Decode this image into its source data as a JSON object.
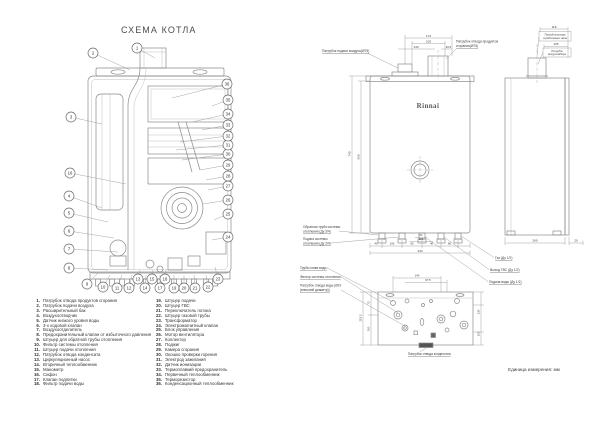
{
  "page": {
    "title": "СХЕМА КОТЛА",
    "unit_note": "Единица измерения: мм",
    "brand": "Rinnai"
  },
  "parts_list": [
    {
      "num": "1.",
      "label": "Патрубок отвода продуктов сгорания"
    },
    {
      "num": "2.",
      "label": "Патрубок подачи воздуха"
    },
    {
      "num": "3.",
      "label": "Расширительный бак"
    },
    {
      "num": "4.",
      "label": "Воздухоотводчик"
    },
    {
      "num": "5.",
      "label": "Датчик низкого уровня воды"
    },
    {
      "num": "6.",
      "label": "3-х ходовой клапан"
    },
    {
      "num": "7.",
      "label": "Воздухоотделитель"
    },
    {
      "num": "8.",
      "label": "Предохранительный клапан от избыточного давления"
    },
    {
      "num": "9.",
      "label": "Штуцер для обратной трубы отопления"
    },
    {
      "num": "10.",
      "label": "Фильтр системы отопления"
    },
    {
      "num": "11.",
      "label": "Штуцер подачи отопления"
    },
    {
      "num": "12.",
      "label": "Патрубок отвода конденсата"
    },
    {
      "num": "13.",
      "label": "Циркуляционный насос"
    },
    {
      "num": "14.",
      "label": "Вторичный теплообменник"
    },
    {
      "num": "15.",
      "label": "Манометр"
    },
    {
      "num": "16.",
      "label": "Сифон"
    },
    {
      "num": "17.",
      "label": "Клапан подпитки"
    },
    {
      "num": "18.",
      "label": "Фильтр подачи воды"
    },
    {
      "num": "19.",
      "label": "Штуцер подачи"
    },
    {
      "num": "20.",
      "label": "Штуцер ГВС"
    },
    {
      "num": "21.",
      "label": "Переключатель потока"
    },
    {
      "num": "22.",
      "label": "Штуцер газовой трубы"
    },
    {
      "num": "23.",
      "label": "Трансформатор"
    },
    {
      "num": "24.",
      "label": "Электромагнитный клапан"
    },
    {
      "num": "25.",
      "label": "Блок управления"
    },
    {
      "num": "26.",
      "label": "Мотор вентилятора"
    },
    {
      "num": "27.",
      "label": "Коллектор"
    },
    {
      "num": "28.",
      "label": "Поджиг"
    },
    {
      "num": "29.",
      "label": "Камера сгорания"
    },
    {
      "num": "30.",
      "label": "Окошко проверки горения"
    },
    {
      "num": "31.",
      "label": "Электрод зажигания"
    },
    {
      "num": "32.",
      "label": "Датчик ионизации"
    },
    {
      "num": "33.",
      "label": "Термоплавкий предохранитель"
    },
    {
      "num": "34.",
      "label": "Первичный теплообменник"
    },
    {
      "num": "35.",
      "label": "Терморезистор"
    },
    {
      "num": "36.",
      "label": "Конденсационный теплообменник"
    }
  ],
  "cutaway": {
    "callouts": [
      {
        "n": "1",
        "x": 77,
        "y": 6,
        "tx": 95,
        "ty": 16
      },
      {
        "n": "2",
        "x": 33,
        "y": 11,
        "tx": 70,
        "ty": 28
      },
      {
        "n": "3",
        "x": 11,
        "y": 75,
        "tx": 42,
        "ty": 82
      },
      {
        "n": "16",
        "x": 10,
        "y": 131,
        "tx": 66,
        "ty": 142
      },
      {
        "n": "4",
        "x": 9,
        "y": 154,
        "tx": 42,
        "ty": 166
      },
      {
        "n": "5",
        "x": 9,
        "y": 171,
        "tx": 48,
        "ty": 180
      },
      {
        "n": "6",
        "x": 9,
        "y": 189,
        "tx": 54,
        "ty": 196
      },
      {
        "n": "7",
        "x": 9,
        "y": 207,
        "tx": 58,
        "ty": 210
      },
      {
        "n": "8",
        "x": 9,
        "y": 226,
        "tx": 48,
        "ty": 228
      },
      {
        "n": "9",
        "x": 27,
        "y": 242,
        "tx": 38,
        "ty": 231
      },
      {
        "n": "10",
        "x": 43,
        "y": 245,
        "tx": 50,
        "ty": 233
      },
      {
        "n": "11",
        "x": 57,
        "y": 246,
        "tx": 62,
        "ty": 233
      },
      {
        "n": "12",
        "x": 69,
        "y": 246,
        "tx": 72,
        "ty": 233
      },
      {
        "n": "13",
        "x": 78,
        "y": 237,
        "tx": 80,
        "ty": 228
      },
      {
        "n": "14",
        "x": 85,
        "y": 246,
        "tx": 86,
        "ty": 233
      },
      {
        "n": "15",
        "x": 92,
        "y": 237,
        "tx": 93,
        "ty": 228
      },
      {
        "n": "17",
        "x": 100,
        "y": 246,
        "tx": 100,
        "ty": 233
      },
      {
        "n": "18",
        "x": 105,
        "y": 237,
        "tx": 106,
        "ty": 228
      },
      {
        "n": "19",
        "x": 114,
        "y": 246,
        "tx": 114,
        "ty": 233
      },
      {
        "n": "20",
        "x": 124,
        "y": 246,
        "tx": 124,
        "ty": 233
      },
      {
        "n": "21",
        "x": 135,
        "y": 246,
        "tx": 134,
        "ty": 233
      },
      {
        "n": "22",
        "x": 148,
        "y": 245,
        "tx": 146,
        "ty": 233
      },
      {
        "n": "23",
        "x": 158,
        "y": 237,
        "tx": 155,
        "ty": 225
      },
      {
        "n": "24",
        "x": 168,
        "y": 195,
        "tx": 152,
        "ty": 198
      },
      {
        "n": "25",
        "x": 168,
        "y": 172,
        "tx": 154,
        "ty": 178
      },
      {
        "n": "26",
        "x": 168,
        "y": 158,
        "tx": 143,
        "ty": 162
      },
      {
        "n": "27",
        "x": 168,
        "y": 144,
        "tx": 148,
        "ty": 148
      },
      {
        "n": "28",
        "x": 168,
        "y": 134,
        "tx": 146,
        "ty": 138
      },
      {
        "n": "29",
        "x": 168,
        "y": 123,
        "tx": 140,
        "ty": 128
      },
      {
        "n": "30",
        "x": 168,
        "y": 112,
        "tx": 122,
        "ty": 118
      },
      {
        "n": "31",
        "x": 168,
        "y": 103,
        "tx": 116,
        "ty": 108
      },
      {
        "n": "32",
        "x": 168,
        "y": 94,
        "tx": 120,
        "ty": 100
      },
      {
        "n": "33",
        "x": 168,
        "y": 83,
        "tx": 142,
        "ty": 88
      },
      {
        "n": "34",
        "x": 168,
        "y": 72,
        "tx": 132,
        "ty": 80
      },
      {
        "n": "35",
        "x": 168,
        "y": 58,
        "tx": 152,
        "ty": 64
      },
      {
        "n": "36",
        "x": 167,
        "y": 42,
        "tx": 112,
        "ty": 56
      }
    ]
  },
  "drawings": {
    "annotations": [
      {
        "t": "Патрубок подачи воздуха(Ø75)",
        "x": 27,
        "y": 30,
        "a": "start",
        "s": 3.3,
        "u": 1
      },
      {
        "t": "Патрубок отвода продуктов",
        "x": 161,
        "y": 20.5,
        "a": "start",
        "s": 3.3
      },
      {
        "t": "сгорания(Ø75)",
        "x": 161,
        "y": 25,
        "a": "start",
        "s": 3.3,
        "u": 1
      },
      {
        "t": "Rinnai",
        "x": 133,
        "y": 86,
        "a": "middle",
        "s": 7,
        "cls": "brand"
      },
      {
        "t": "Обратная труба системы",
        "x": 8,
        "y": 206,
        "a": "start",
        "s": 3.2
      },
      {
        "t": "отопления (Ду 3/4)",
        "x": 8,
        "y": 210.5,
        "a": "start",
        "s": 3.2,
        "u": 1
      },
      {
        "t": "Подача системы",
        "x": 8,
        "y": 218,
        "a": "start",
        "s": 3.2
      },
      {
        "t": "отопления (Ду 3/4)",
        "x": 8,
        "y": 222.5,
        "a": "start",
        "s": 3.2,
        "u": 1
      },
      {
        "t": "Газ (Ду 1/2)",
        "x": 200,
        "y": 237,
        "a": "start",
        "s": 3.3,
        "u": 1
      },
      {
        "t": "Выход ГВС (Ду 1/2)",
        "x": 195,
        "y": 249,
        "a": "start",
        "s": 3.3,
        "u": 1
      },
      {
        "t": "Подача воды (Ду 1/2)",
        "x": 194,
        "y": 261,
        "a": "start",
        "s": 3.3,
        "u": 1
      },
      {
        "t": "Патрубок выхода",
        "x": 260,
        "y": 13.5,
        "a": "middle",
        "s": 2.6
      },
      {
        "t": "отработанных газов",
        "x": 260,
        "y": 17,
        "a": "middle",
        "s": 2.6
      },
      {
        "t": "Патрубок",
        "x": 262,
        "y": 29.8,
        "a": "middle",
        "s": 2.6
      },
      {
        "t": "воздухозабора",
        "x": 262,
        "y": 33.2,
        "a": "middle",
        "s": 2.6
      },
      {
        "t": "Труба слива воды",
        "x": 5,
        "y": 247,
        "a": "start",
        "s": 3.2,
        "u": 1
      },
      {
        "t": "Фильтр системы отопления",
        "x": 5,
        "y": 256,
        "a": "start",
        "s": 3.2,
        "u": 1
      },
      {
        "t": "Патрубок отвода воды (Ø19",
        "x": 5,
        "y": 264.5,
        "a": "start",
        "s": 3.2
      },
      {
        "t": "(внешний диаметр))",
        "x": 5,
        "y": 269,
        "a": "start",
        "s": 3.2,
        "u": 1
      },
      {
        "t": "Патрубок отвода конденсата",
        "x": 113,
        "y": 333,
        "a": "start",
        "s": 3.2,
        "u": 1
      },
      {
        "t": "Единица измерения: мм",
        "x": 213,
        "y": 349,
        "a": "start",
        "s": 4.6
      },
      {
        "t": "173",
        "x": 133.5,
        "y": 14.8,
        "a": "middle",
        "s": 3
      },
      {
        "t": "100",
        "x": 133.5,
        "y": 20.3,
        "a": "middle",
        "s": 3
      },
      {
        "t": "140",
        "x": 121,
        "y": 25.8,
        "a": "middle",
        "s": 3
      },
      {
        "t": "26.5",
        "x": 153.5,
        "y": 25.8,
        "a": "middle",
        "s": 2.8
      },
      {
        "t": "740",
        "x": 55.5,
        "y": 132,
        "a": "middle",
        "s": 3,
        "r": -90
      },
      {
        "t": "660",
        "x": 64.5,
        "y": 135,
        "a": "middle",
        "s": 3,
        "r": -90
      },
      {
        "t": "40",
        "x": 81,
        "y": 222.6,
        "a": "middle",
        "s": 2.8
      },
      {
        "t": "100",
        "x": 97,
        "y": 222.6,
        "a": "middle",
        "s": 2.8
      },
      {
        "t": "60",
        "x": 117,
        "y": 222.6,
        "a": "middle",
        "s": 2.8
      },
      {
        "t": "40",
        "x": 136.5,
        "y": 222.6,
        "a": "middle",
        "s": 2.8
      },
      {
        "t": "80",
        "x": 154.5,
        "y": 222.6,
        "a": "middle",
        "s": 2.8
      },
      {
        "t": "52",
        "x": 126,
        "y": 214.2,
        "a": "middle",
        "s": 2.6
      },
      {
        "t": "100",
        "x": 126,
        "y": 218.2,
        "a": "middle",
        "s": 2.6
      },
      {
        "t": "440",
        "x": 125,
        "y": 229.8,
        "a": "middle",
        "s": 3
      },
      {
        "t": "118",
        "x": 259,
        "y": 5.8,
        "a": "middle",
        "s": 3
      },
      {
        "t": "105",
        "x": 261,
        "y": 23.2,
        "a": "middle",
        "s": 3
      },
      {
        "t": "260",
        "x": 240,
        "y": 219.6,
        "a": "middle",
        "s": 3
      },
      {
        "t": "20",
        "x": 281,
        "y": 219.6,
        "a": "middle",
        "s": 3
      },
      {
        "t": "140",
        "x": 122,
        "y": 254.6,
        "a": "middle",
        "s": 2.8
      },
      {
        "t": "97.5",
        "x": 133,
        "y": 259.2,
        "a": "middle",
        "s": 2.8
      },
      {
        "t": "219.5",
        "x": 66.5,
        "y": 296,
        "a": "middle",
        "s": 2.8,
        "r": -90
      },
      {
        "t": "73",
        "x": 74.5,
        "y": 281,
        "a": "middle",
        "s": 2.8,
        "r": -90
      },
      {
        "t": "100",
        "x": 74.5,
        "y": 307,
        "a": "middle",
        "s": 2.8,
        "r": -90
      },
      {
        "t": "130",
        "x": 184.5,
        "y": 290,
        "a": "middle",
        "s": 2.8,
        "r": -90
      },
      {
        "t": "100",
        "x": 184.5,
        "y": 312,
        "a": "middle",
        "s": 2.8,
        "r": -90
      }
    ]
  }
}
